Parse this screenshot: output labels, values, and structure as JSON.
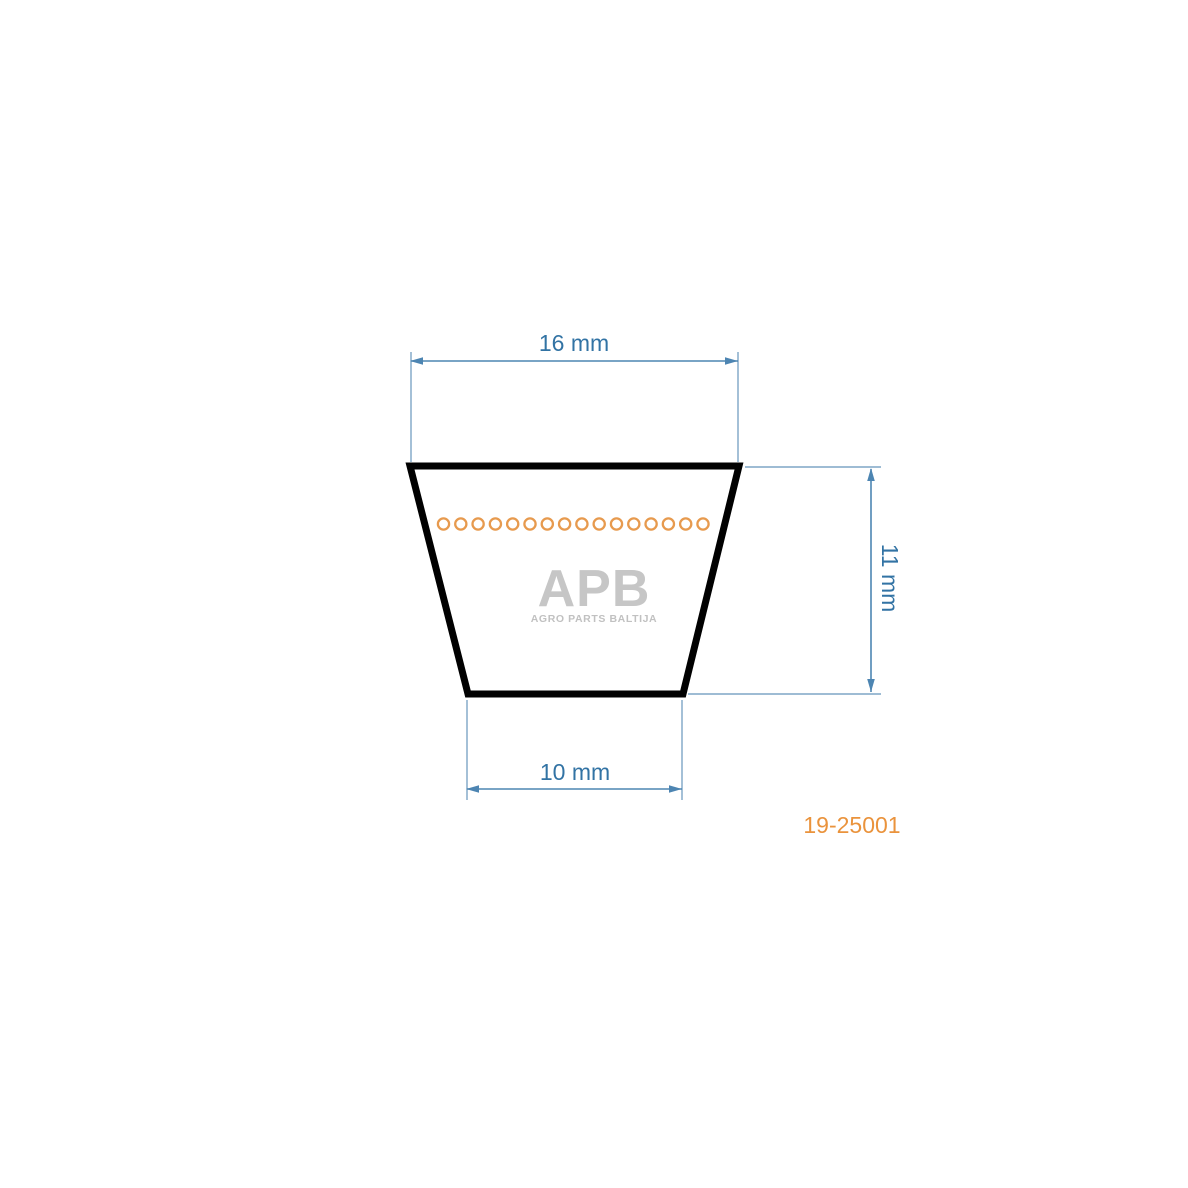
{
  "diagram": {
    "dimensions": {
      "top_width": "16 mm",
      "bottom_width": "10 mm",
      "height": "11 mm"
    },
    "part_number": "19-25001",
    "logo": {
      "name": "APB",
      "subtitle": "AGRO PARTS BALTIJA"
    },
    "cord": {
      "count": 16
    },
    "colors": {
      "dimension_text_blue": "#3273a4",
      "dimension_line_blue": "#4d85b2",
      "extension_line_blue": "#7ea6c6",
      "cord_circle_orange": "#e79a4e",
      "part_number_orange": "#ea933c",
      "belt_outline_black": "#010101",
      "logo_gray": "#c6c6c6"
    }
  }
}
